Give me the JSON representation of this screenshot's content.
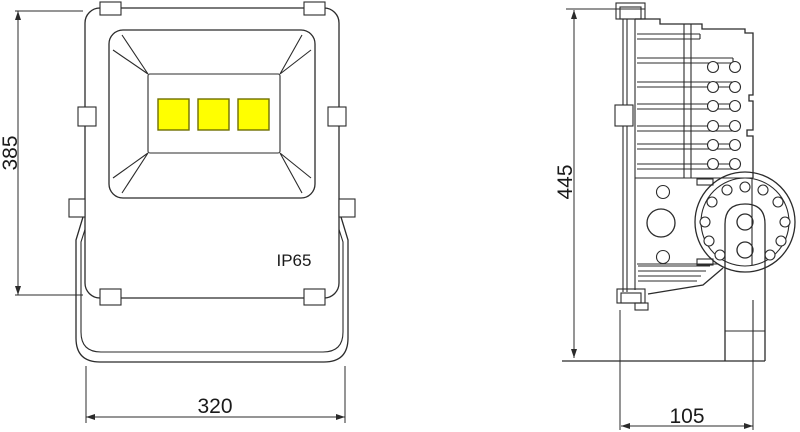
{
  "drawing": {
    "background": "#ffffff",
    "line_color": "#2b2b2b",
    "front_view": {
      "ip_rating": "IP65",
      "dim_height": "385",
      "dim_width": "320",
      "led_count": 3,
      "led_color": "#ffff00"
    },
    "side_view": {
      "dim_height": "445",
      "dim_width": "105"
    }
  }
}
